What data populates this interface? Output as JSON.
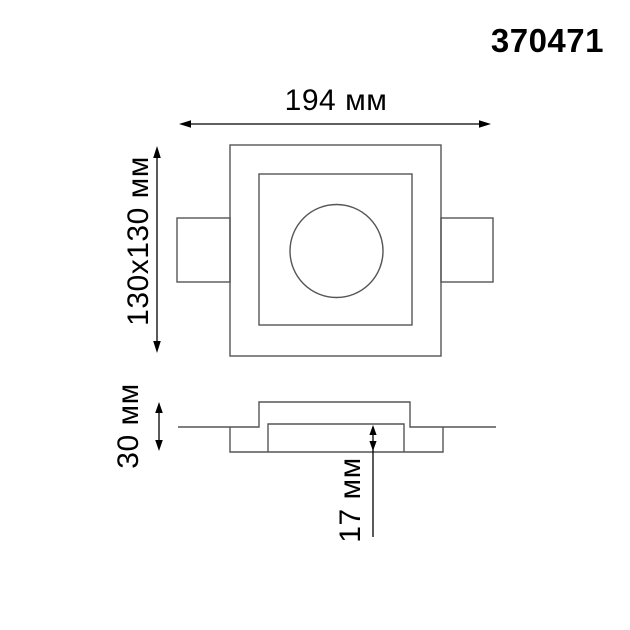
{
  "product": {
    "number": "370471"
  },
  "drawing": {
    "title": "recessed-spot-dimension-drawing",
    "dim_width_label": "194 мм",
    "dim_cutout_label": "130x130 мм",
    "dim_height_label": "30 мм",
    "dim_depth_label": "17 мм"
  },
  "colors": {
    "background": "#ffffff",
    "outline": "#555555",
    "dimension": "#000000",
    "text": "#000000"
  }
}
